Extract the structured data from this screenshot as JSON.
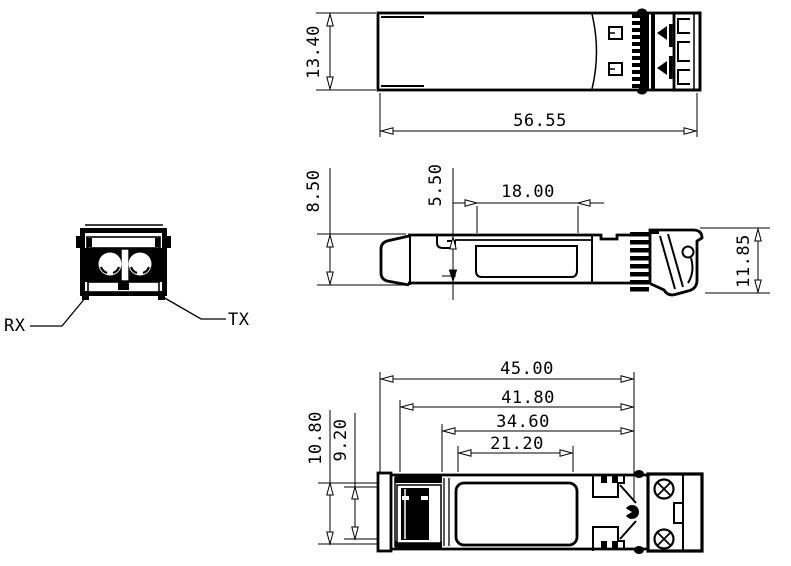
{
  "colors": {
    "ink": "#000000",
    "paper": "#ffffff"
  },
  "front_view": {
    "rx_label": "RX",
    "tx_label": "TX"
  },
  "top_view": {
    "width": "13.40",
    "length": "56.55"
  },
  "side_view": {
    "height": "8.50",
    "recess_offset": "5.50",
    "recess_length": "18.00",
    "latch_height": "11.85"
  },
  "bottom_view": {
    "length_overall": "45.00",
    "length_2": "41.80",
    "length_3": "34.60",
    "label_length": "21.20",
    "width_outer": "10.80",
    "width_inner": "9.20"
  }
}
